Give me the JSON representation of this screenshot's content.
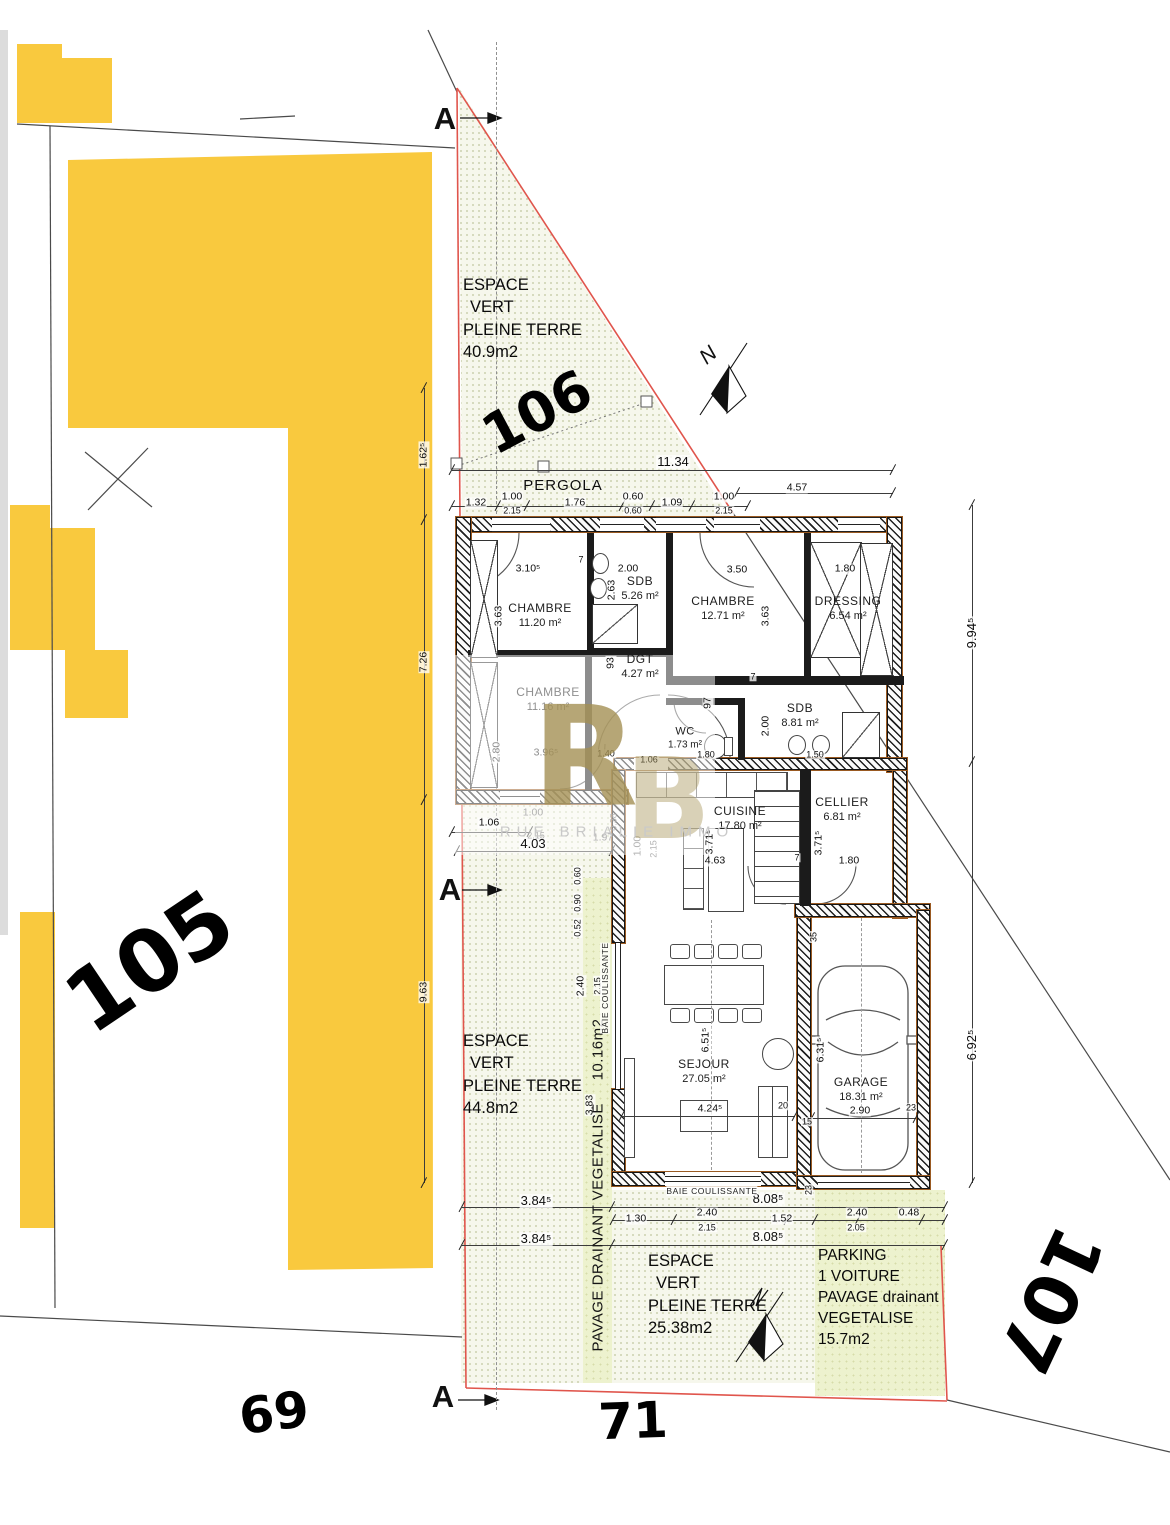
{
  "parcels": {
    "p105": "105",
    "p106": "106",
    "p107": "107",
    "street_69": "69",
    "street_71": "71"
  },
  "north": "N",
  "section": {
    "marker": "A"
  },
  "watermark": {
    "letter_r": "R",
    "letter_b": "B",
    "text": "RUE BRIALIE IMMO"
  },
  "site_areas": {
    "ev_top": {
      "line1": "ESPACE",
      "line2": "VERT",
      "line3": "PLEINE TERRE",
      "area": "40.9m2"
    },
    "ev_left": {
      "line1": "ESPACE",
      "line2": "VERT",
      "line3": "PLEINE TERRE",
      "area": "44.8m2"
    },
    "ev_bottom": {
      "line1": "ESPACE",
      "line2": "VERT",
      "line3": "PLEINE TERRE",
      "area": "25.38m2"
    },
    "pavage_strip": {
      "label": "PAVAGE DRAINANT VEGETALISE",
      "area": "10.16m2"
    },
    "parking": {
      "line1": "PARKING",
      "line2": "1 VOITURE",
      "line3": "PAVAGE drainant",
      "line4": "VEGETALISE",
      "area": "15.7m2"
    },
    "pergola": "PERGOLA"
  },
  "features": {
    "baie1": "BAIE COULISSANTE",
    "baie2": "BAIE COULISSANTE"
  },
  "rooms": {
    "chambre1": {
      "name": "CHAMBRE",
      "area": "11.20 m²"
    },
    "sdb1": {
      "name": "SDB",
      "area": "5.26 m²"
    },
    "chambre2": {
      "name": "CHAMBRE",
      "area": "12.71 m²"
    },
    "dressing": {
      "name": "DRESSING",
      "area": "6.54 m²"
    },
    "chambre3": {
      "name": "CHAMBRE",
      "area": "11.16 m²"
    },
    "dgt": {
      "name": "DGT",
      "area": "4.27 m²"
    },
    "wc": {
      "name": "WC",
      "area": "1.73 m²"
    },
    "sdb2": {
      "name": "SDB",
      "area": "8.81 m²"
    },
    "cuisine": {
      "name": "CUISINE",
      "area": "17.80 m²"
    },
    "cellier": {
      "name": "CELLIER",
      "area": "6.81 m²"
    },
    "sejour": {
      "name": "SEJOUR",
      "area": "27.05 m²"
    },
    "garage": {
      "name": "GARAGE",
      "area": "18.31 m²"
    }
  },
  "dims": {
    "total_top": "11.34",
    "top_457": "4.57",
    "top_132": "1.32",
    "top_100a": "1.00",
    "top_215a": "2.15",
    "top_176": "1.76",
    "top_060a": "0.60",
    "top_060b": "0.60",
    "top_109": "1.09",
    "top_100b": "1.00",
    "top_215b": "2.15",
    "left_1625": "1.62⁵",
    "left_726": "7.26",
    "left_963": "9.63",
    "left_106": "1.06",
    "left_403": "4.03",
    "right_9945": "9.94⁵",
    "right_6925": "6.92⁵",
    "bottom_3845a": "3.84⁵",
    "bottom_8085a": "8.08⁵",
    "bottom_3845b": "3.84⁵",
    "bottom_8085b": "8.08⁵",
    "bottom_130": "1.30",
    "bottom_240a": "2.40",
    "bottom_215": "2.15",
    "bottom_152": "1.52",
    "bottom_240b": "2.40",
    "bottom_205": "2.05",
    "bottom_048": "0.48",
    "c1_3105": "3.10⁵",
    "c1_363": "3.63",
    "sdb1_200": "2.00",
    "sdb1_263": "2.63",
    "c2_350": "3.50",
    "c2_363": "3.63",
    "dr_180": "1.80",
    "dgt_93": "93",
    "dgt_97": "97",
    "c3_3965": "3.96⁵",
    "c3_280": "2.80",
    "wc_140": "1.40",
    "wc_106": "1.06",
    "wc_180": "1.80",
    "sdb2_200": "2.00",
    "sdb2_150": "1.50",
    "cui_3715": "3.71⁵",
    "cui_463": "4.63",
    "cel_3715": "3.71⁵",
    "cel_180": "1.80",
    "sej_6515": "6.51⁵",
    "sej_4245": "4.24⁵",
    "sej_20": "20",
    "gar_6315": "6.31⁵",
    "gar_290": "2.90",
    "gar_35": "35",
    "gar_15": "15",
    "gar_23a": "23",
    "gar_23b": "23",
    "strip_060": "0.60",
    "strip_090": "0.90",
    "strip_052": "0.52",
    "strip_240": "2.40",
    "strip_215": "2.15",
    "strip_383": "3.83",
    "wall_7a": "7",
    "wall_7b": "7",
    "wall_7c": "7",
    "grey_100a": "1.00",
    "grey_215a": "2.15",
    "grey_197": "1.97",
    "grey_038": "0.38",
    "grey_100b": "1.00",
    "grey_215b": "2.15"
  }
}
